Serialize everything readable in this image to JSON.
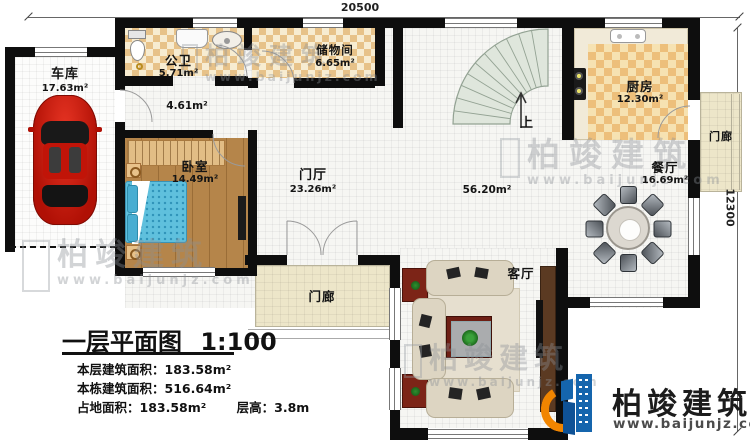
{
  "plan": {
    "title": "一层平面图",
    "scale": "1:100",
    "dim_top": "20500",
    "dim_right": "12300",
    "stats": [
      {
        "label": "本层建筑面积：",
        "value": "183.58m²"
      },
      {
        "label": "本栋建筑面积：",
        "value": "516.64m²"
      },
      {
        "label": "占地面积：",
        "value": "183.58m²"
      },
      {
        "label": "层高：",
        "value": "3.8m"
      }
    ],
    "rooms": {
      "garage": {
        "name": "车库",
        "area": "17.63m²"
      },
      "bathroom": {
        "name": "公卫",
        "area": "5.71m²"
      },
      "storage": {
        "name": "储物间",
        "area": "6.65m²"
      },
      "hallway": {
        "area": "4.61m²"
      },
      "bedroom": {
        "name": "卧室",
        "area": "14.49m²"
      },
      "foyer": {
        "name": "门厅",
        "area": "23.26m²"
      },
      "hall_open": {
        "area": "56.20m²"
      },
      "kitchen": {
        "name": "厨房",
        "area": "12.30m²"
      },
      "dining": {
        "name": "餐厅",
        "area": "16.69m²"
      },
      "living": {
        "name": "客厅"
      },
      "porch_right": {
        "name": "门廊"
      },
      "porch_bottom": {
        "name": "门廊"
      },
      "stairs": {
        "up": "上"
      }
    }
  },
  "branding": {
    "company": "柏竣建筑",
    "website": "www.baijunjz.com"
  },
  "colors": {
    "wall": "#0e0e0e",
    "tile_tan": "#e7c289",
    "tile_cream": "#f7ecd1",
    "wood": "#b5854a",
    "logo_blue": "#1565ad",
    "logo_orange": "#f18500",
    "car_red": "#c4150c"
  }
}
